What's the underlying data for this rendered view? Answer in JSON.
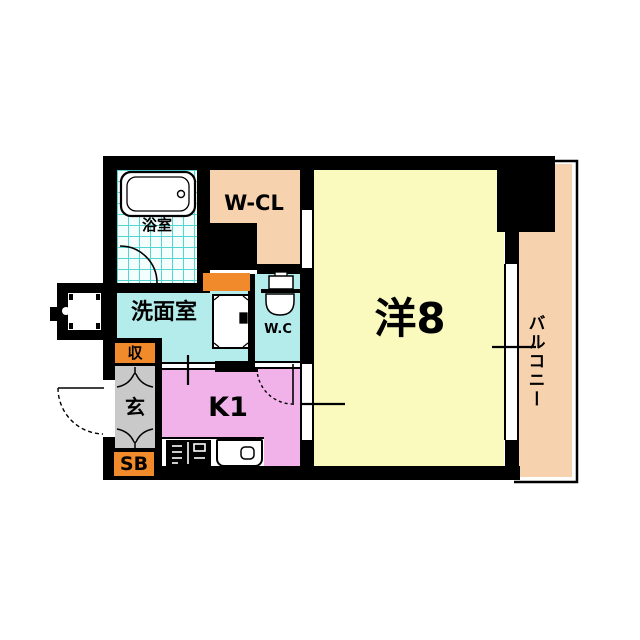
{
  "floorplan": {
    "type": "japanese-apartment-floor-plan",
    "rooms": {
      "bath": {
        "label": "浴室"
      },
      "walk_in_closet": {
        "label": "W-CL"
      },
      "washroom": {
        "label": "洗面室"
      },
      "toilet": {
        "label": "W.C"
      },
      "western_room": {
        "label": "洋8"
      },
      "kitchen": {
        "label": "K1"
      },
      "entrance": {
        "label": "玄"
      },
      "storage": {
        "label": "収"
      },
      "shoe_box": {
        "label": "SB"
      },
      "balcony": {
        "label": "バルコニー"
      }
    },
    "icons": [
      "bathtub-icon",
      "toilet-icon",
      "washing-machine-icon",
      "stove-icon",
      "sink-icon",
      "meter-box-icon",
      "door-swing-arc",
      "sliding-door-window",
      "balcony-railing"
    ],
    "colors": {
      "wall": "#000000",
      "western_room_yellow": "#fafabe",
      "closet_peach": "#f6d2ae",
      "balcony_peach": "#f6d2ae",
      "water_area_cyan": "#b4ecec",
      "kitchen_pink": "#f1b2e9",
      "entrance_gray": "#c9c9c9",
      "accent_orange": "#f08a2a",
      "bath_tile_line": "#55d4d4",
      "bath_tile_bg": "#f4fffd",
      "background": "#ffffff"
    }
  }
}
